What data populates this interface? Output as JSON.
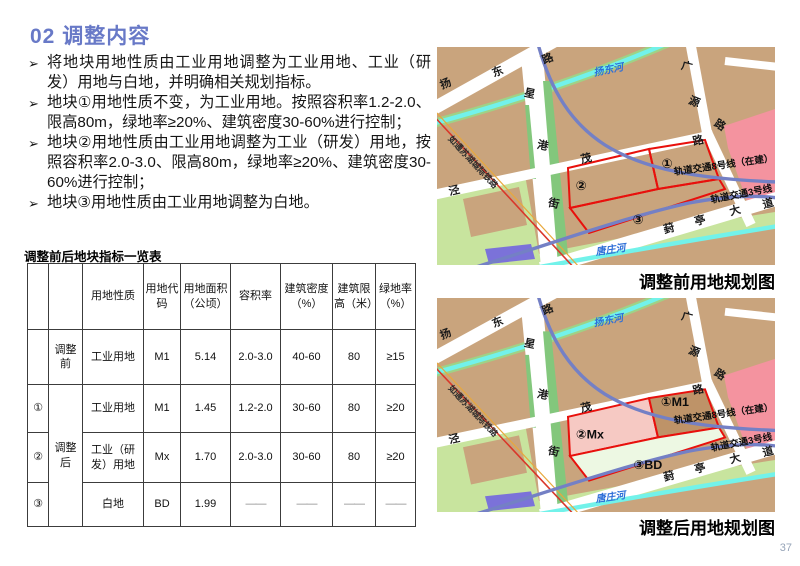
{
  "title": "02 调整内容",
  "bullet_marker": "➢",
  "bullets": [
    "将地块用地性质由工业用地调整为工业用地、工业（研发）用地与白地，并明确相关规划指标。",
    "地块①用地性质不变，为工业用地。按照容积率1.2-2.0、限高80m，绿地率≥20%、建筑密度30-60%进行控制；",
    "地块②用地性质由工业用地调整为工业（研发）用地，按照容积率2.0-3.0、限高80m，绿地率≥20%、建筑密度30-60%进行控制；",
    "地块③用地性质由工业用地调整为白地。"
  ],
  "table": {
    "title": "调整前后地块指标一览表",
    "headers": [
      "",
      "",
      "用地性质",
      "用地代码",
      "用地面积（公顷）",
      "容积率",
      "建筑密度（%）",
      "建筑限高（米）",
      "绿地率（%）"
    ],
    "rows": [
      {
        "id": "",
        "phase": "调整前",
        "nature": "工业用地",
        "code": "M1",
        "area": "5.14",
        "far": "2.0-3.0",
        "density": "40-60",
        "height": "80",
        "green": "≥15"
      },
      {
        "id": "①",
        "phase": "调整后",
        "nature": "工业用地",
        "code": "M1",
        "area": "1.45",
        "far": "1.2-2.0",
        "density": "30-60",
        "height": "80",
        "green": "≥20"
      },
      {
        "id": "②",
        "nature": "工业（研发）用地",
        "code": "Mx",
        "area": "1.70",
        "far": "2.0-3.0",
        "density": "30-60",
        "height": "80",
        "green": "≥20"
      },
      {
        "id": "③",
        "nature": "白地",
        "code": "BD",
        "area": "1.99",
        "far": "——",
        "density": "——",
        "height": "——",
        "green": "——"
      }
    ]
  },
  "maps": {
    "roads": {
      "yangdong": "扬东路",
      "xinggang": "星港街",
      "jingmao": "泾茂路",
      "guangyuan": "广源路",
      "fengting": "葑亭大道"
    },
    "railway": "如通苏湖城际铁路",
    "rivers": {
      "yangdonghe": "扬东河",
      "tangzhuanghe": "唐庄河"
    },
    "metro": {
      "line8": "轨道交通8号线（在建）",
      "line3": "轨道交通3号线"
    },
    "before": {
      "caption": "调整前用地规划图",
      "parcels": {
        "p1": "①",
        "p2": "②",
        "p3": "③"
      }
    },
    "after": {
      "caption": "调整后用地规划图",
      "parcels": {
        "p1": "①M1",
        "p2": "②Mx",
        "p3": "③BD"
      }
    }
  },
  "colors": {
    "accent_title": "#6879C7",
    "map_land": "#C9A47D",
    "map_green": "#C8E49E",
    "map_green_dark": "#83C77C",
    "river": "#72F2EA",
    "metro_line": "#7480C5",
    "railway_red": "#D9372A",
    "parcel_outline": "#E8100C",
    "pink_zone": "#F4939F",
    "parcel_m1_fill": "#BE9368",
    "parcel_mx_fill": "#F6C9C3",
    "parcel_bd_fill": "#EDF8E3",
    "purple_block": "#7B72D9",
    "river_label": "#2E6FD8"
  },
  "page_number": "37"
}
